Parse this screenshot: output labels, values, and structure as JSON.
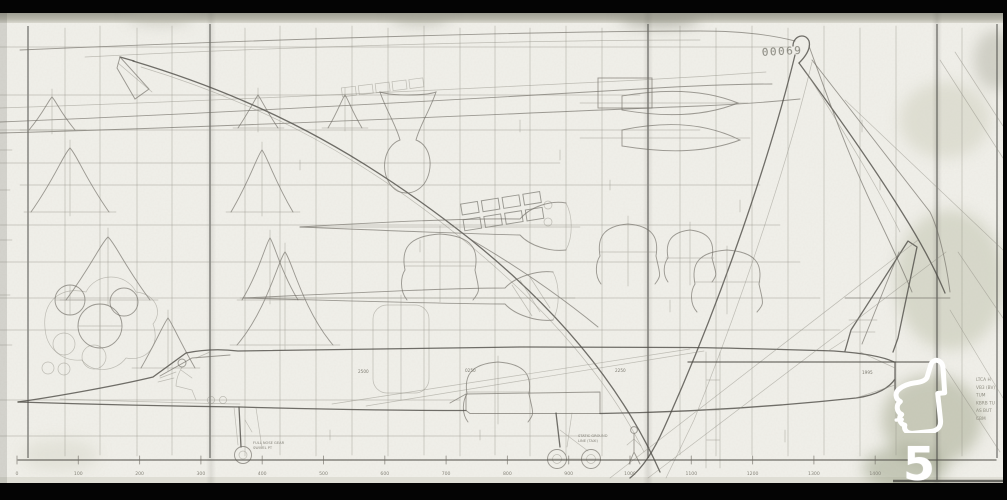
{
  "viewer": {
    "overlay_number": "5",
    "like_icon": "thumbs-up"
  },
  "drawing": {
    "handwritten_number": "00069",
    "margin_notes": [
      "LTCA H",
      "VB3 (BV)",
      "TUM",
      "KBRB TU",
      "AS BUT",
      "CBM"
    ],
    "nose_gear_note_1": "FULL NOSE GEAR",
    "nose_gear_note_2": "SWIVEL PT",
    "main_gear_note_1": "STATIC GROUND",
    "main_gear_note_2": "LINE (TAXI)",
    "dim_labels": [
      "2500",
      "0250",
      "2250",
      "1995"
    ],
    "scale_stations": [
      "0",
      "100",
      "200",
      "300",
      "400",
      "500",
      "600",
      "700",
      "800",
      "900",
      "1000",
      "1100",
      "1200",
      "1300",
      "1400"
    ]
  },
  "colors": {
    "letterbox": "#040404",
    "paper": "#f0efe9",
    "pencil": "#4f4d47",
    "overlay_white": "#ffffff"
  }
}
